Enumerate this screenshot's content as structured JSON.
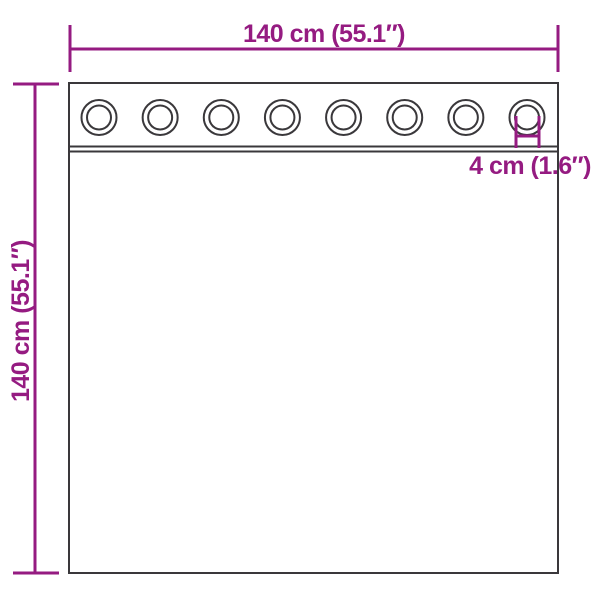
{
  "diagram": {
    "type": "product-dimension-diagram",
    "subject": "curtain-with-grommets",
    "background_color": "#ffffff",
    "accent_color": "#951b81",
    "outline_color": "#3a383b",
    "width_label": "140 cm (55.1″)",
    "height_label": "140 cm (55.1″)",
    "grommet_label": "4 cm (1.6″)",
    "measurements": {
      "width_cm": 140,
      "width_in": 55.1,
      "height_cm": 140,
      "height_in": 55.1,
      "grommet_diameter_cm": 4,
      "grommet_diameter_in": 1.6
    },
    "grommet_count": 8
  }
}
